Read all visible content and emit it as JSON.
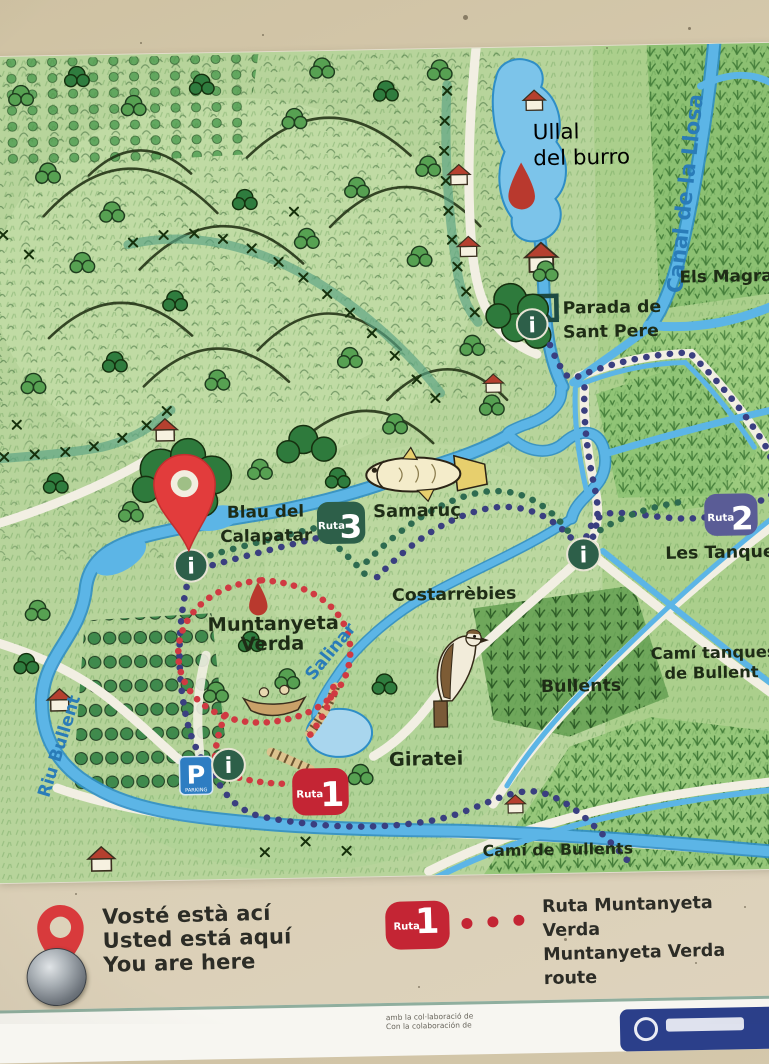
{
  "colors": {
    "sign_beige": "#d7cbb0",
    "map_green": "#b7d49b",
    "water_blue": "#5cb5e6",
    "route1_red": "#c42534",
    "route2_purple": "#5a5c96",
    "route3_green": "#2d5f49",
    "info_green": "#2d5f49",
    "parking_blue": "#2e7dc2",
    "pin_red": "#e23c3c",
    "label_blue": "#2a7cb8",
    "label_red": "#a83522",
    "trail_navy": "#3a3f80",
    "trail_green": "#2e6b50",
    "trail_red": "#d03a42"
  },
  "map": {
    "labels": {
      "ullal": [
        "Ullal",
        "del burro"
      ],
      "canal": "Canal de la Llosa",
      "els_magran": "Els Magran",
      "parada": [
        "Parada de",
        "Sant Pere"
      ],
      "samaruc": "Samaruç",
      "blau": [
        "Blau del",
        "Calapatar"
      ],
      "costarrebies": "Costarrèbies",
      "muntanyeta": [
        "Muntanyeta",
        "Verda"
      ],
      "salinar": "Salinar",
      "bullents": "Bullents",
      "cami_tanques": [
        "Camí tanques",
        "de Bullent"
      ],
      "les_tanques": "Les Tanques",
      "cami_bullents": "Camí de Bullents",
      "giratei": "Giratei",
      "riu_bullent": "Riu Bullent"
    },
    "badges": {
      "ruta1": {
        "prefix": "Ruta",
        "number": "1"
      },
      "ruta2": {
        "prefix": "Ruta",
        "number": "2"
      },
      "ruta3": {
        "prefix": "Ruta",
        "number": "3"
      }
    },
    "icons": {
      "info": "i",
      "parking": "P",
      "parking_label": "PARKING"
    }
  },
  "legend": {
    "you_are_here": [
      "Vosté està ací",
      "Usted está aquí",
      "You are here"
    ],
    "route_badge": {
      "prefix": "Ruta",
      "number": "1"
    },
    "route_name": [
      "Ruta Muntanyeta Verda",
      "Muntanyeta Verda route"
    ]
  },
  "footer": {
    "credits": [
      "amb la col·laboració de",
      "Con la colaboración de"
    ]
  }
}
